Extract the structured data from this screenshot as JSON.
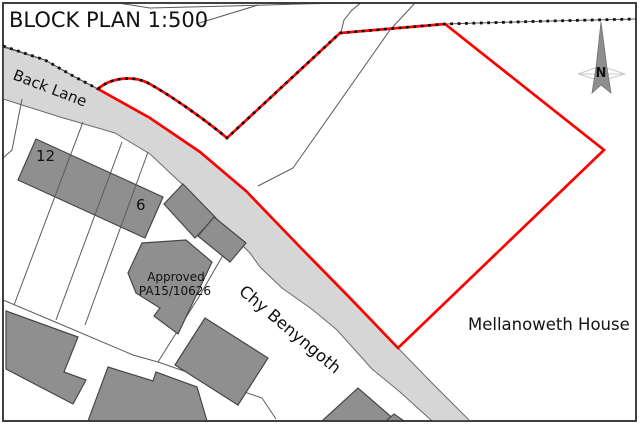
{
  "title": "BLOCK PLAN 1:500",
  "north": {
    "label": "N"
  },
  "roads": {
    "back_lane": "Back Lane",
    "chy_benyngoth": "Chy Benyngoth"
  },
  "places": {
    "mellanoweth": "Mellanoweth House",
    "approved_line1": "Approved",
    "approved_line2": "PA15/10626",
    "house_12": "12",
    "house_6": "6"
  },
  "colors": {
    "boundary_red": "#fe0000",
    "road_fill": "#d6d6d6",
    "road_edge": "#6b6b6b",
    "building_fill": "#8f8f8f",
    "building_stroke": "#474747",
    "thin_line": "#5a5a5a",
    "dots": "#111111",
    "border": "#2f2f2f",
    "arrow_fill": "#8e8e8e",
    "arrow_faint": "#c9c9c9",
    "text": "#111111"
  }
}
